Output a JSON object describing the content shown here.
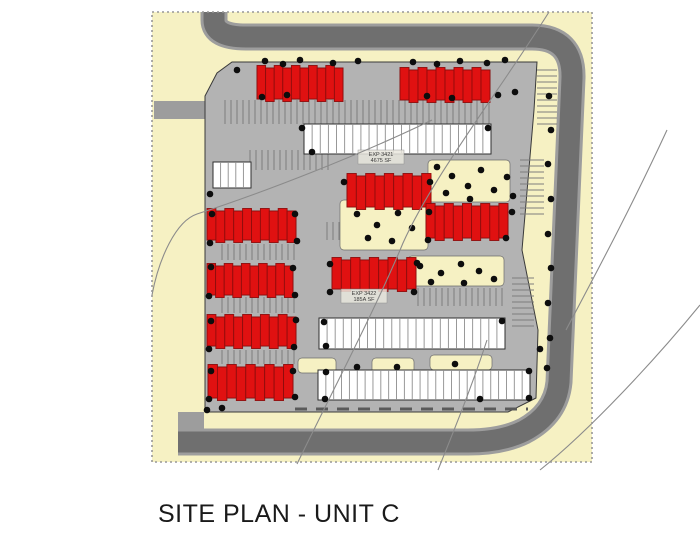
{
  "caption": "SITE PLAN - UNIT C",
  "colors": {
    "page_bg": "#ffffff",
    "site_bg": "#f6f1c3",
    "border_dash": "#979797",
    "road": "#6f6f6f",
    "road_edge": "#9d9d9d",
    "lot": "#b3b3b3",
    "lot_outline": "#3a3a3a",
    "building_red": "#e01111",
    "building_red_line": "#8f0d0d",
    "building_white": "#ffffff",
    "building_white_line": "#8d8d8d",
    "building_outline": "#2f2f2f",
    "hatch_line": "#7d7d7d",
    "tree": "#0d0d0d",
    "contour": "#8b8b8b",
    "curb": "#5a5a5a",
    "label_text": "#3a3a3a",
    "label_bg": "#e9e7de"
  },
  "plan": {
    "site": {
      "x": 152,
      "y": 12,
      "w": 440,
      "h": 450
    },
    "road_path": "M214,12 L214,20 Q214,37 246,37 L532,37 Q573,37 572,78 L559,382 Q556,414 524,431 Q502,442 468,442 L178,442",
    "lot_points": "232,62 537,62 534,110 522,250 538,330 536,398 508,412 205,412 205,96 217,73",
    "stubs": [
      [
        154,
        101,
        52,
        18
      ],
      [
        178,
        412,
        26,
        30
      ]
    ],
    "buildings": {
      "red": [
        [
          257,
          68,
          86,
          31
        ],
        [
          400,
          70,
          90,
          30
        ],
        [
          347,
          176,
          84,
          31
        ],
        [
          426,
          206,
          82,
          32
        ],
        [
          207,
          211,
          89,
          29
        ],
        [
          207,
          266,
          86,
          29
        ],
        [
          332,
          260,
          84,
          29
        ],
        [
          207,
          317,
          89,
          29
        ],
        [
          208,
          367,
          85,
          31
        ]
      ],
      "white": [
        [
          304,
          124,
          187,
          30
        ],
        [
          213,
          162,
          38,
          26
        ],
        [
          319,
          318,
          186,
          31
        ],
        [
          318,
          370,
          212,
          30
        ]
      ]
    },
    "hatches": [
      [
        225,
        100,
        265,
        24,
        "v"
      ],
      [
        250,
        150,
        78,
        20,
        "v"
      ],
      [
        355,
        138,
        135,
        15,
        "v"
      ],
      [
        327,
        222,
        58,
        18,
        "v"
      ],
      [
        418,
        288,
        84,
        18,
        "v"
      ],
      [
        222,
        244,
        75,
        16,
        "v"
      ],
      [
        222,
        297,
        75,
        16,
        "v"
      ],
      [
        222,
        350,
        75,
        14,
        "v"
      ],
      [
        537,
        70,
        20,
        58,
        "h"
      ],
      [
        520,
        160,
        24,
        55,
        "h"
      ],
      [
        512,
        278,
        22,
        48,
        "h"
      ]
    ],
    "patches": [
      [
        340,
        200,
        88,
        50
      ],
      [
        408,
        256,
        96,
        30
      ],
      [
        428,
        160,
        82,
        42
      ],
      [
        298,
        358,
        38,
        15
      ],
      [
        372,
        358,
        42,
        15
      ],
      [
        430,
        355,
        62,
        15
      ]
    ],
    "curbs": [
      [
        295,
        409,
        528,
        409
      ]
    ],
    "trees": [
      [
        265,
        61
      ],
      [
        283,
        64
      ],
      [
        300,
        60
      ],
      [
        333,
        63
      ],
      [
        358,
        61
      ],
      [
        413,
        62
      ],
      [
        437,
        64
      ],
      [
        460,
        61
      ],
      [
        487,
        63
      ],
      [
        505,
        60
      ],
      [
        262,
        97
      ],
      [
        287,
        95
      ],
      [
        427,
        96
      ],
      [
        452,
        98
      ],
      [
        498,
        95
      ],
      [
        515,
        92
      ],
      [
        302,
        128
      ],
      [
        312,
        152
      ],
      [
        488,
        128
      ],
      [
        437,
        167
      ],
      [
        452,
        176
      ],
      [
        468,
        186
      ],
      [
        481,
        170
      ],
      [
        494,
        190
      ],
      [
        446,
        193
      ],
      [
        470,
        199
      ],
      [
        507,
        177
      ],
      [
        513,
        196
      ],
      [
        357,
        214
      ],
      [
        377,
        225
      ],
      [
        398,
        213
      ],
      [
        368,
        238
      ],
      [
        392,
        241
      ],
      [
        412,
        228
      ],
      [
        344,
        182
      ],
      [
        430,
        182
      ],
      [
        429,
        212
      ],
      [
        512,
        212
      ],
      [
        428,
        240
      ],
      [
        506,
        238
      ],
      [
        330,
        264
      ],
      [
        417,
        263
      ],
      [
        330,
        292
      ],
      [
        414,
        292
      ],
      [
        420,
        266
      ],
      [
        441,
        273
      ],
      [
        461,
        264
      ],
      [
        479,
        271
      ],
      [
        494,
        279
      ],
      [
        431,
        282
      ],
      [
        464,
        283
      ],
      [
        210,
        194
      ],
      [
        212,
        214
      ],
      [
        210,
        243
      ],
      [
        211,
        267
      ],
      [
        209,
        296
      ],
      [
        211,
        321
      ],
      [
        209,
        349
      ],
      [
        211,
        371
      ],
      [
        209,
        399
      ],
      [
        295,
        214
      ],
      [
        297,
        241
      ],
      [
        293,
        268
      ],
      [
        295,
        295
      ],
      [
        296,
        320
      ],
      [
        294,
        347
      ],
      [
        293,
        371
      ],
      [
        295,
        397
      ],
      [
        324,
        322
      ],
      [
        502,
        321
      ],
      [
        326,
        346
      ],
      [
        326,
        372
      ],
      [
        357,
        367
      ],
      [
        397,
        367
      ],
      [
        455,
        364
      ],
      [
        529,
        371
      ],
      [
        540,
        349
      ],
      [
        325,
        399
      ],
      [
        529,
        398
      ],
      [
        480,
        399
      ],
      [
        549,
        96
      ],
      [
        551,
        130
      ],
      [
        548,
        164
      ],
      [
        551,
        199
      ],
      [
        548,
        234
      ],
      [
        551,
        268
      ],
      [
        548,
        303
      ],
      [
        550,
        338
      ],
      [
        547,
        368
      ],
      [
        207,
        410
      ],
      [
        222,
        408
      ],
      [
        237,
        70
      ]
    ],
    "labels": [
      {
        "x": 381,
        "y": 156,
        "line1": "EXP 3421",
        "line2": "4675 SF"
      },
      {
        "x": 364,
        "y": 295,
        "line1": "EXP 3422",
        "line2": "185A SF"
      }
    ],
    "contours": [
      "M549,12 C500,90 432,178 403,243 C376,308 331,394 297,464",
      "M432,120 C360,155 262,193 197,214 C176,221 159,258 152,295",
      "M667,130 C630,210 595,275 566,330",
      "M700,305 C655,360 590,430 540,470",
      "M487,340 C470,392 450,440 438,470"
    ]
  }
}
